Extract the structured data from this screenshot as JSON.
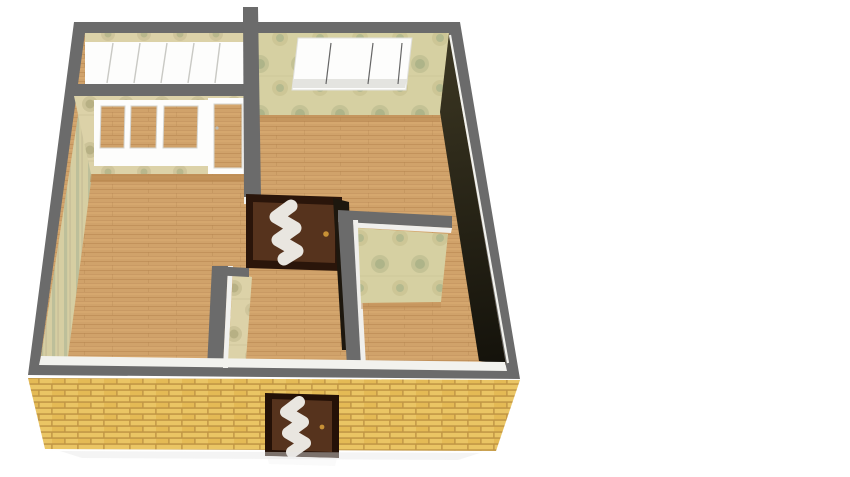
{
  "scene": {
    "description": "3D top-down render of an apartment floor plan with glazed balcony, three rooms, hallway, two zigzag-glass doors and a yellow brick facade",
    "background": "#ffffff"
  },
  "colors": {
    "wall_cap": "#6b6b6b",
    "trim_white": "#f2f2ee",
    "wood": "#d0a26a",
    "wood_edge": "#b8874f",
    "brick": "#eac564",
    "brick_alt": "#e4ba55",
    "mortar": "#c09544",
    "wallpaper_beige": "#dcd2a8",
    "wallpaper_green": "#d6d0a2",
    "stripe_light": "#d6cea2",
    "stripe_dark": "#bdbf9a",
    "dark_wall_top": "#3d3823",
    "dark_wall_bottom": "#14120b",
    "door_wood": "#56331d",
    "door_frame": "#2a150a",
    "door_glass": "#e9e6e0",
    "handle_gold": "#c79136",
    "window_white": "#fdfdfc",
    "window_sill": "#e4e4e0",
    "glass_divider": "#666666",
    "glazing_divider": "#c9c9c4",
    "pane_frame": "#d5d5d0",
    "ground_shadow": "#e7e7e7"
  },
  "features": {
    "balcony_glazing_panels": 6,
    "balcony_window_panes": 3,
    "balcony_doors": 1,
    "north_room_window_panes": 3,
    "interior_doors": 1,
    "entrance_doors": 1
  }
}
